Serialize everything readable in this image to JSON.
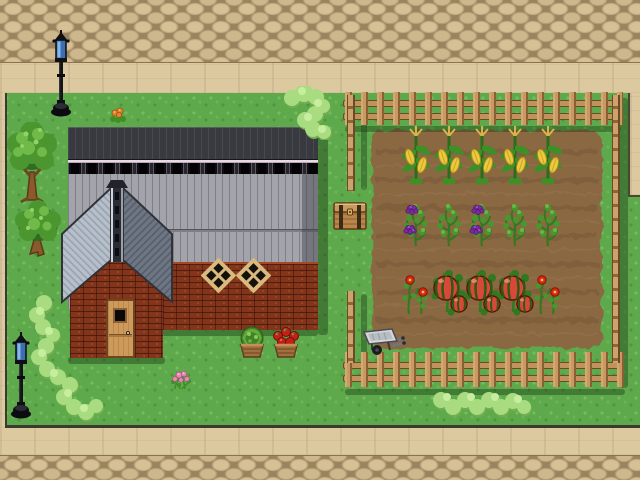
{
  "scene": "top-down pixel-art farm map",
  "palette": {
    "cobblestone": "#c7ae84",
    "sidewalk": "#dcc9a0",
    "grass": "#5ea94b",
    "grass_edge": "#3a3a2e",
    "hedge": "#a9dc80",
    "dirt": "#8a6843",
    "dirt_furrow": "#775638",
    "fence_wood": "#c79a62",
    "barn_dark_siding": "#393940",
    "barn_trim": "#ead9e4",
    "barn_roof_gray": "#a3a4ab",
    "annex_roof_light": "#b6bfca",
    "annex_roof_dark": "#6e7684",
    "brick": "#82351a",
    "door_wood": "#cd9a5a",
    "window_frame": "#d9ba7e",
    "lamp_glass": "#4a7fc0",
    "corn_ear": "#ecc93e",
    "grape_purple": "#7a2aa0",
    "tomato_red": "#d84838",
    "leaf_green": "#3f8f28"
  },
  "garden": {
    "fence_sides": [
      "top",
      "right",
      "bottom",
      "left-partial-with-gap"
    ],
    "columns_x": [
      416,
      449,
      482,
      515,
      548
    ],
    "rows": [
      {
        "crop": "corn",
        "y_bottom": 186,
        "stages": [
          "tasseled",
          "tasseled",
          "tasseled",
          "tasseled",
          "tasseled"
        ]
      },
      {
        "crop": "grape-vine",
        "y_bottom": 248,
        "stages": [
          "ripe",
          "unripe",
          "ripe",
          "unripe",
          "unripe"
        ]
      },
      {
        "crop": "tomato",
        "y_bottom": 316,
        "stages": [
          "flowering",
          "fruiting",
          "fruiting",
          "fruiting",
          "flowering"
        ]
      }
    ]
  },
  "objects": [
    {
      "name": "street-lamp",
      "x": 61,
      "y": 118
    },
    {
      "name": "street-lamp",
      "x": 21,
      "y": 420
    },
    {
      "name": "tree-large",
      "x": 32,
      "y": 206
    },
    {
      "name": "tree-small",
      "x": 38,
      "y": 258
    },
    {
      "name": "wooden-chest",
      "x": 350,
      "y": 231
    },
    {
      "name": "wheelbarrow",
      "x": 384,
      "y": 356
    },
    {
      "name": "cabbage-barrel",
      "x": 252,
      "y": 359
    },
    {
      "name": "apple-basket",
      "x": 286,
      "y": 359
    },
    {
      "name": "orange-flower",
      "x": 118,
      "y": 123
    },
    {
      "name": "pink-flowers",
      "x": 181,
      "y": 391
    }
  ],
  "environment": [
    "cobblestone path top",
    "cobblestone path bottom",
    "hedge near barn",
    "hedge lower-left",
    "hedge lower-right",
    "barn with brick annex",
    "fenced vegetable garden"
  ]
}
